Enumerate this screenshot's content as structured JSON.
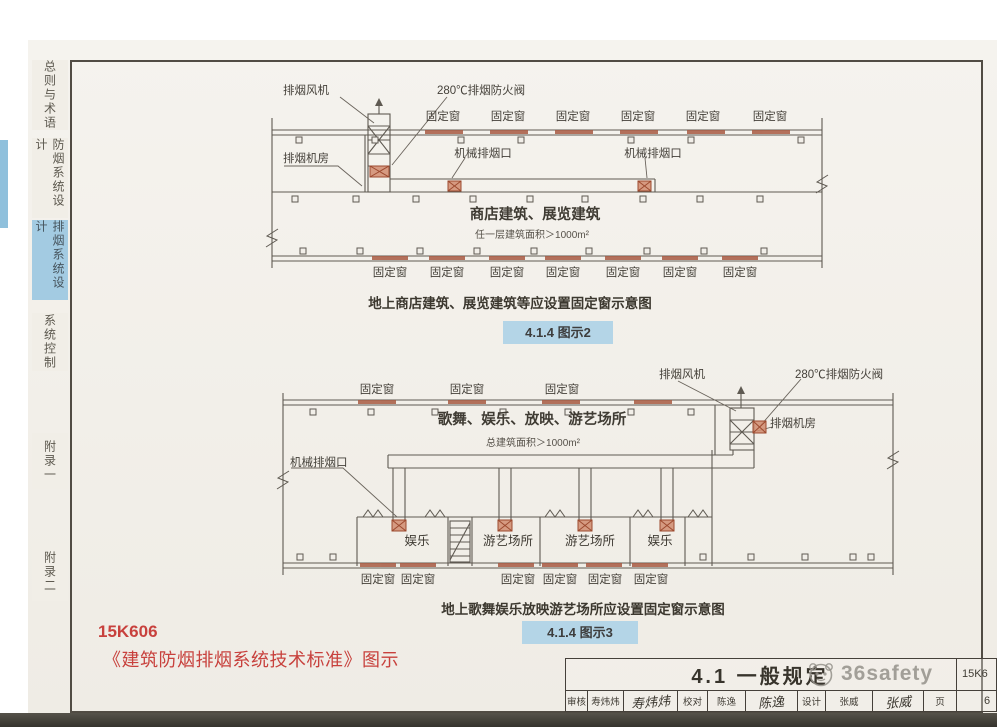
{
  "sidebar": {
    "tabs": [
      "总则与术语",
      "防烟系统设计",
      "排烟系统设计",
      "系统控制",
      "附录一",
      "附录二"
    ],
    "active_index": 2
  },
  "labels": {
    "fixed_window": "固定窗",
    "exhaust_fan": "排烟风机",
    "fire_damper": "280℃排烟防火阀",
    "fan_room": "排烟机房",
    "mech_outlet": "机械排烟口"
  },
  "diagram1": {
    "building": "商店建筑、展览建筑",
    "area_note": "任一层建筑面积＞1000m²",
    "caption": "地上商店建筑、展览建筑等应设置固定窗示意图",
    "figure_tag": "4.1.4 图示2"
  },
  "diagram2": {
    "building": "歌舞、娱乐、放映、游艺场所",
    "area_note": "总建筑面积＞1000m²",
    "rooms": [
      "娱乐",
      "游艺场所",
      "游艺场所",
      "娱乐"
    ],
    "caption": "地上歌舞娱乐放映游艺场所应设置固定窗示意图",
    "figure_tag": "4.1.4 图示3"
  },
  "footer": {
    "atlas_code": "15K606",
    "doc_title": "《建筑防烟排烟系统技术标准》图示"
  },
  "titleblock": {
    "section": "4.1  一般规定",
    "watermark": "36safety",
    "atlas_no": "15K6",
    "page_label": "页",
    "page_no": "6",
    "review_label": "审核",
    "review_name": "寿炜炜",
    "review_sig": "寿炜炜",
    "proof_label": "校对",
    "proof_name": "陈逸",
    "proof_sig": "陈逸",
    "design_label": "设计",
    "design_name": "张威",
    "design_sig": "张威"
  },
  "colors": {
    "badge_blue": "#b4d5e7",
    "tab_active_blue": "#a3cbe2",
    "red_text": "#c8413d",
    "window_red": "#a85a42",
    "line": "#5f5a52"
  }
}
